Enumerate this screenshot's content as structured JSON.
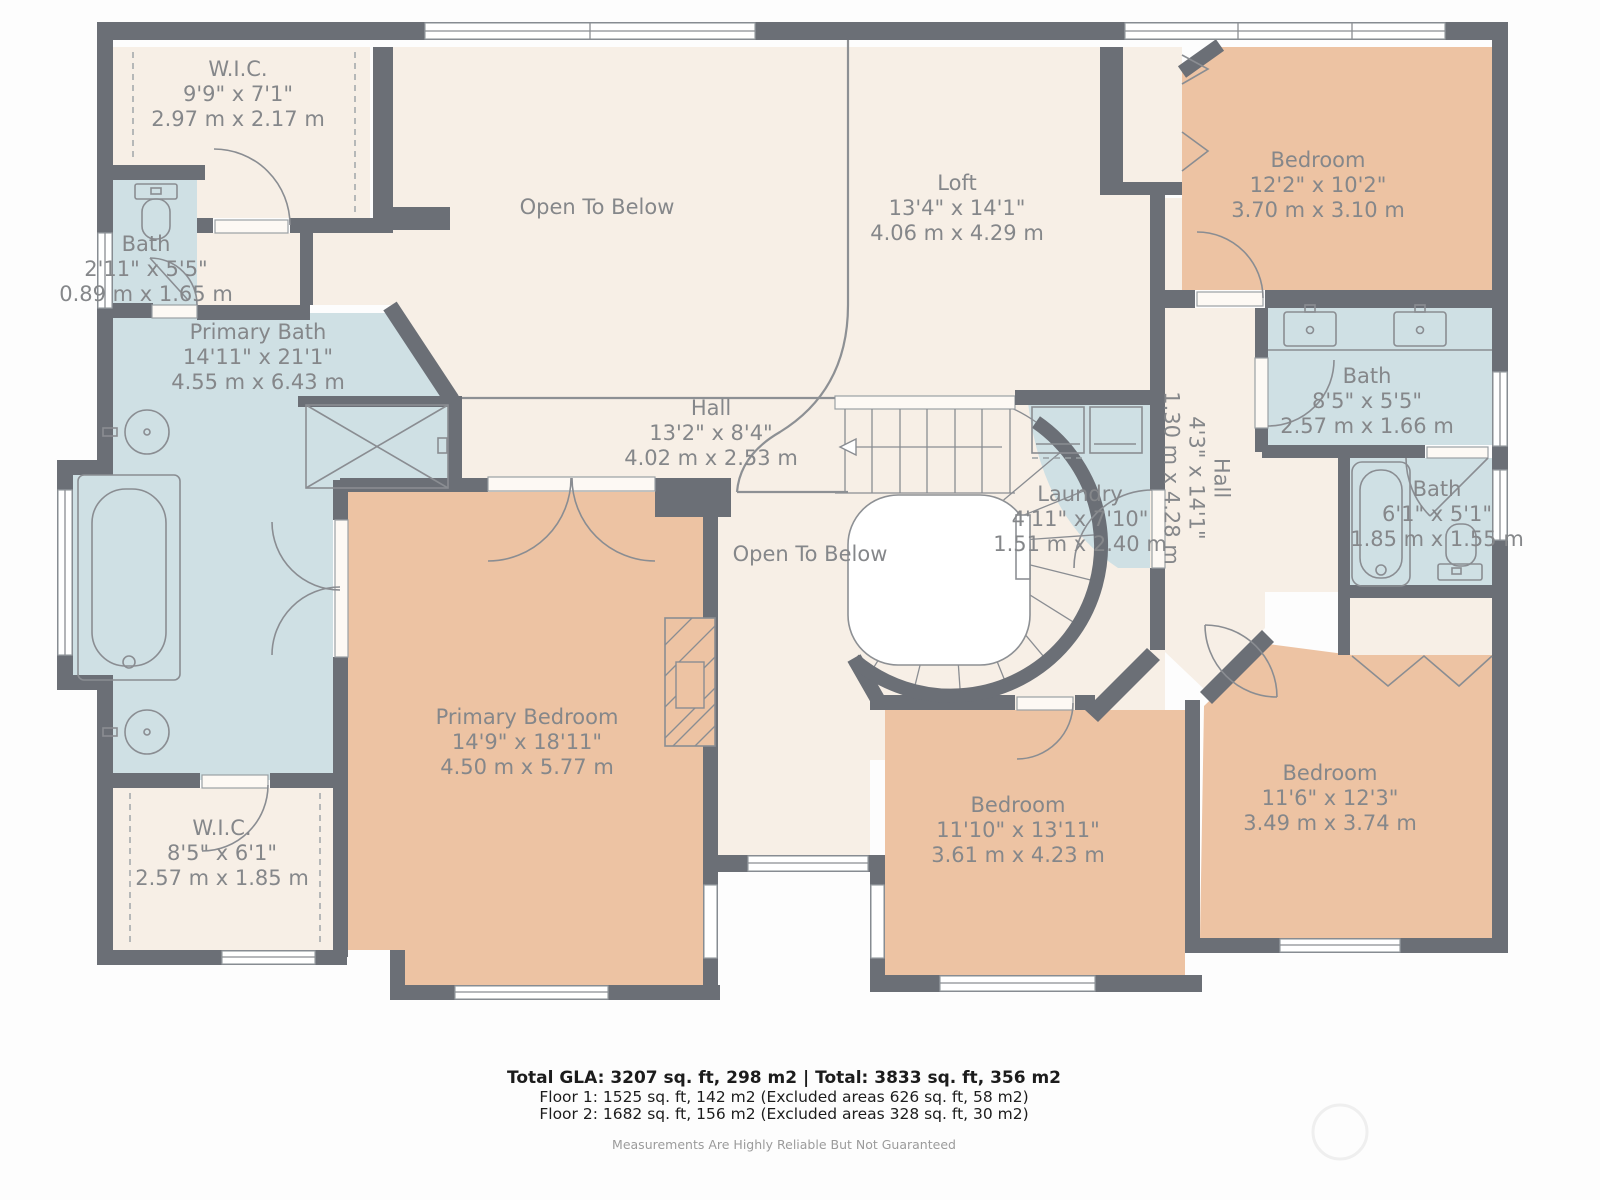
{
  "palette": {
    "wall": "#6b6f76",
    "bedroom": "#edc3a3",
    "bath": "#cfe0e4",
    "hall": "#f7efe6",
    "linecol": "#8a8d92",
    "label_text": "#85878a"
  },
  "rooms": [
    {
      "id": "wic-top",
      "name": "W.I.C.",
      "dims_ft": "9'9\" x 7'1\"",
      "dims_m": "2.97 m x 2.17 m"
    },
    {
      "id": "bath-left",
      "name": "Bath",
      "dims_ft": "2'11\" x 5'5\"",
      "dims_m": "0.89 m x 1.65 m"
    },
    {
      "id": "primary-bath",
      "name": "Primary Bath",
      "dims_ft": "14'11\" x 21'1\"",
      "dims_m": "4.55 m x 6.43 m"
    },
    {
      "id": "loft",
      "name": "Loft",
      "dims_ft": "13'4\" x 14'1\"",
      "dims_m": "4.06 m x 4.29 m"
    },
    {
      "id": "bedroom-top-right",
      "name": "Bedroom",
      "dims_ft": "12'2\" x 10'2\"",
      "dims_m": "3.70 m x 3.10 m"
    },
    {
      "id": "bath-top-right",
      "name": "Bath",
      "dims_ft": "8'5\" x 5'5\"",
      "dims_m": "2.57 m x 1.66 m"
    },
    {
      "id": "hall-center",
      "name": "Hall",
      "dims_ft": "13'2\" x 8'4\"",
      "dims_m": "4.02 m x 2.53 m"
    },
    {
      "id": "laundry",
      "name": "Laundry",
      "dims_ft": "4'11\" x 7'10\"",
      "dims_m": "1.51 m x 2.40 m"
    },
    {
      "id": "hall-right",
      "name": "Hall",
      "dims_ft": "4'3\" x 14'1\"",
      "dims_m": "1.30 m x 4.28 m"
    },
    {
      "id": "bath-right",
      "name": "Bath",
      "dims_ft": "6'1\" x 5'1\"",
      "dims_m": "1.85 m x 1.55 m"
    },
    {
      "id": "primary-bedroom",
      "name": "Primary Bedroom",
      "dims_ft": "14'9\" x 18'11\"",
      "dims_m": "4.50 m x 5.77 m"
    },
    {
      "id": "wic-bottom",
      "name": "W.I.C.",
      "dims_ft": "8'5\" x 6'1\"",
      "dims_m": "2.57 m x 1.85 m"
    },
    {
      "id": "bedroom-mid",
      "name": "Bedroom",
      "dims_ft": "11'10\" x 13'11\"",
      "dims_m": "3.61 m x 4.23 m"
    },
    {
      "id": "bedroom-bottom-right",
      "name": "Bedroom",
      "dims_ft": "11'6\" x 12'3\"",
      "dims_m": "3.49 m x 3.74 m"
    }
  ],
  "open_areas": [
    {
      "label": "Open To Below"
    },
    {
      "label": "Open To Below"
    }
  ],
  "footer": {
    "total": "Total GLA: 3207 sq. ft, 298 m2 | Total: 3833 sq. ft, 356 m2",
    "floor1": "Floor 1: 1525 sq. ft, 142 m2 (Excluded areas 626 sq. ft, 58 m2)",
    "floor2": "Floor 2: 1682 sq. ft, 156 m2 (Excluded areas 328 sq. ft, 30 m2)",
    "disclaimer": "Measurements Are Highly Reliable But Not Guaranteed"
  }
}
